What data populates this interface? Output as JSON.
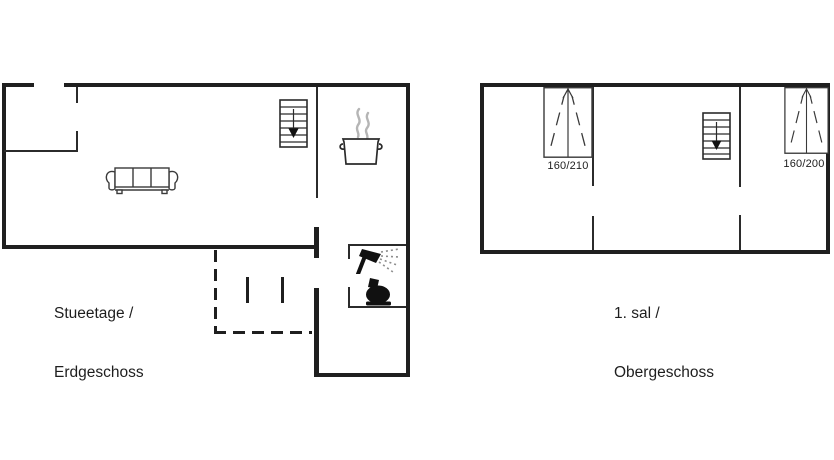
{
  "canvas": {
    "background": "#ffffff",
    "wall_color": "#1f1f1f",
    "steam_color": "#b5b5b5"
  },
  "ground_floor": {
    "label_line1": "Stueetage /",
    "label_line2": "Erdgeschoss",
    "icons": [
      "staircase-down-icon",
      "cooking-pot-icon",
      "sofa-icon",
      "shower-icon",
      "toilet-icon",
      "terrace-dashed-outline"
    ]
  },
  "upper_floor": {
    "label_line1": "1. sal /",
    "label_line2": "Obergeschoss",
    "bed_left_size": "160/210",
    "bed_right_size": "160/200",
    "icons": [
      "double-bed-icon",
      "staircase-down-icon",
      "double-bed-icon"
    ]
  }
}
